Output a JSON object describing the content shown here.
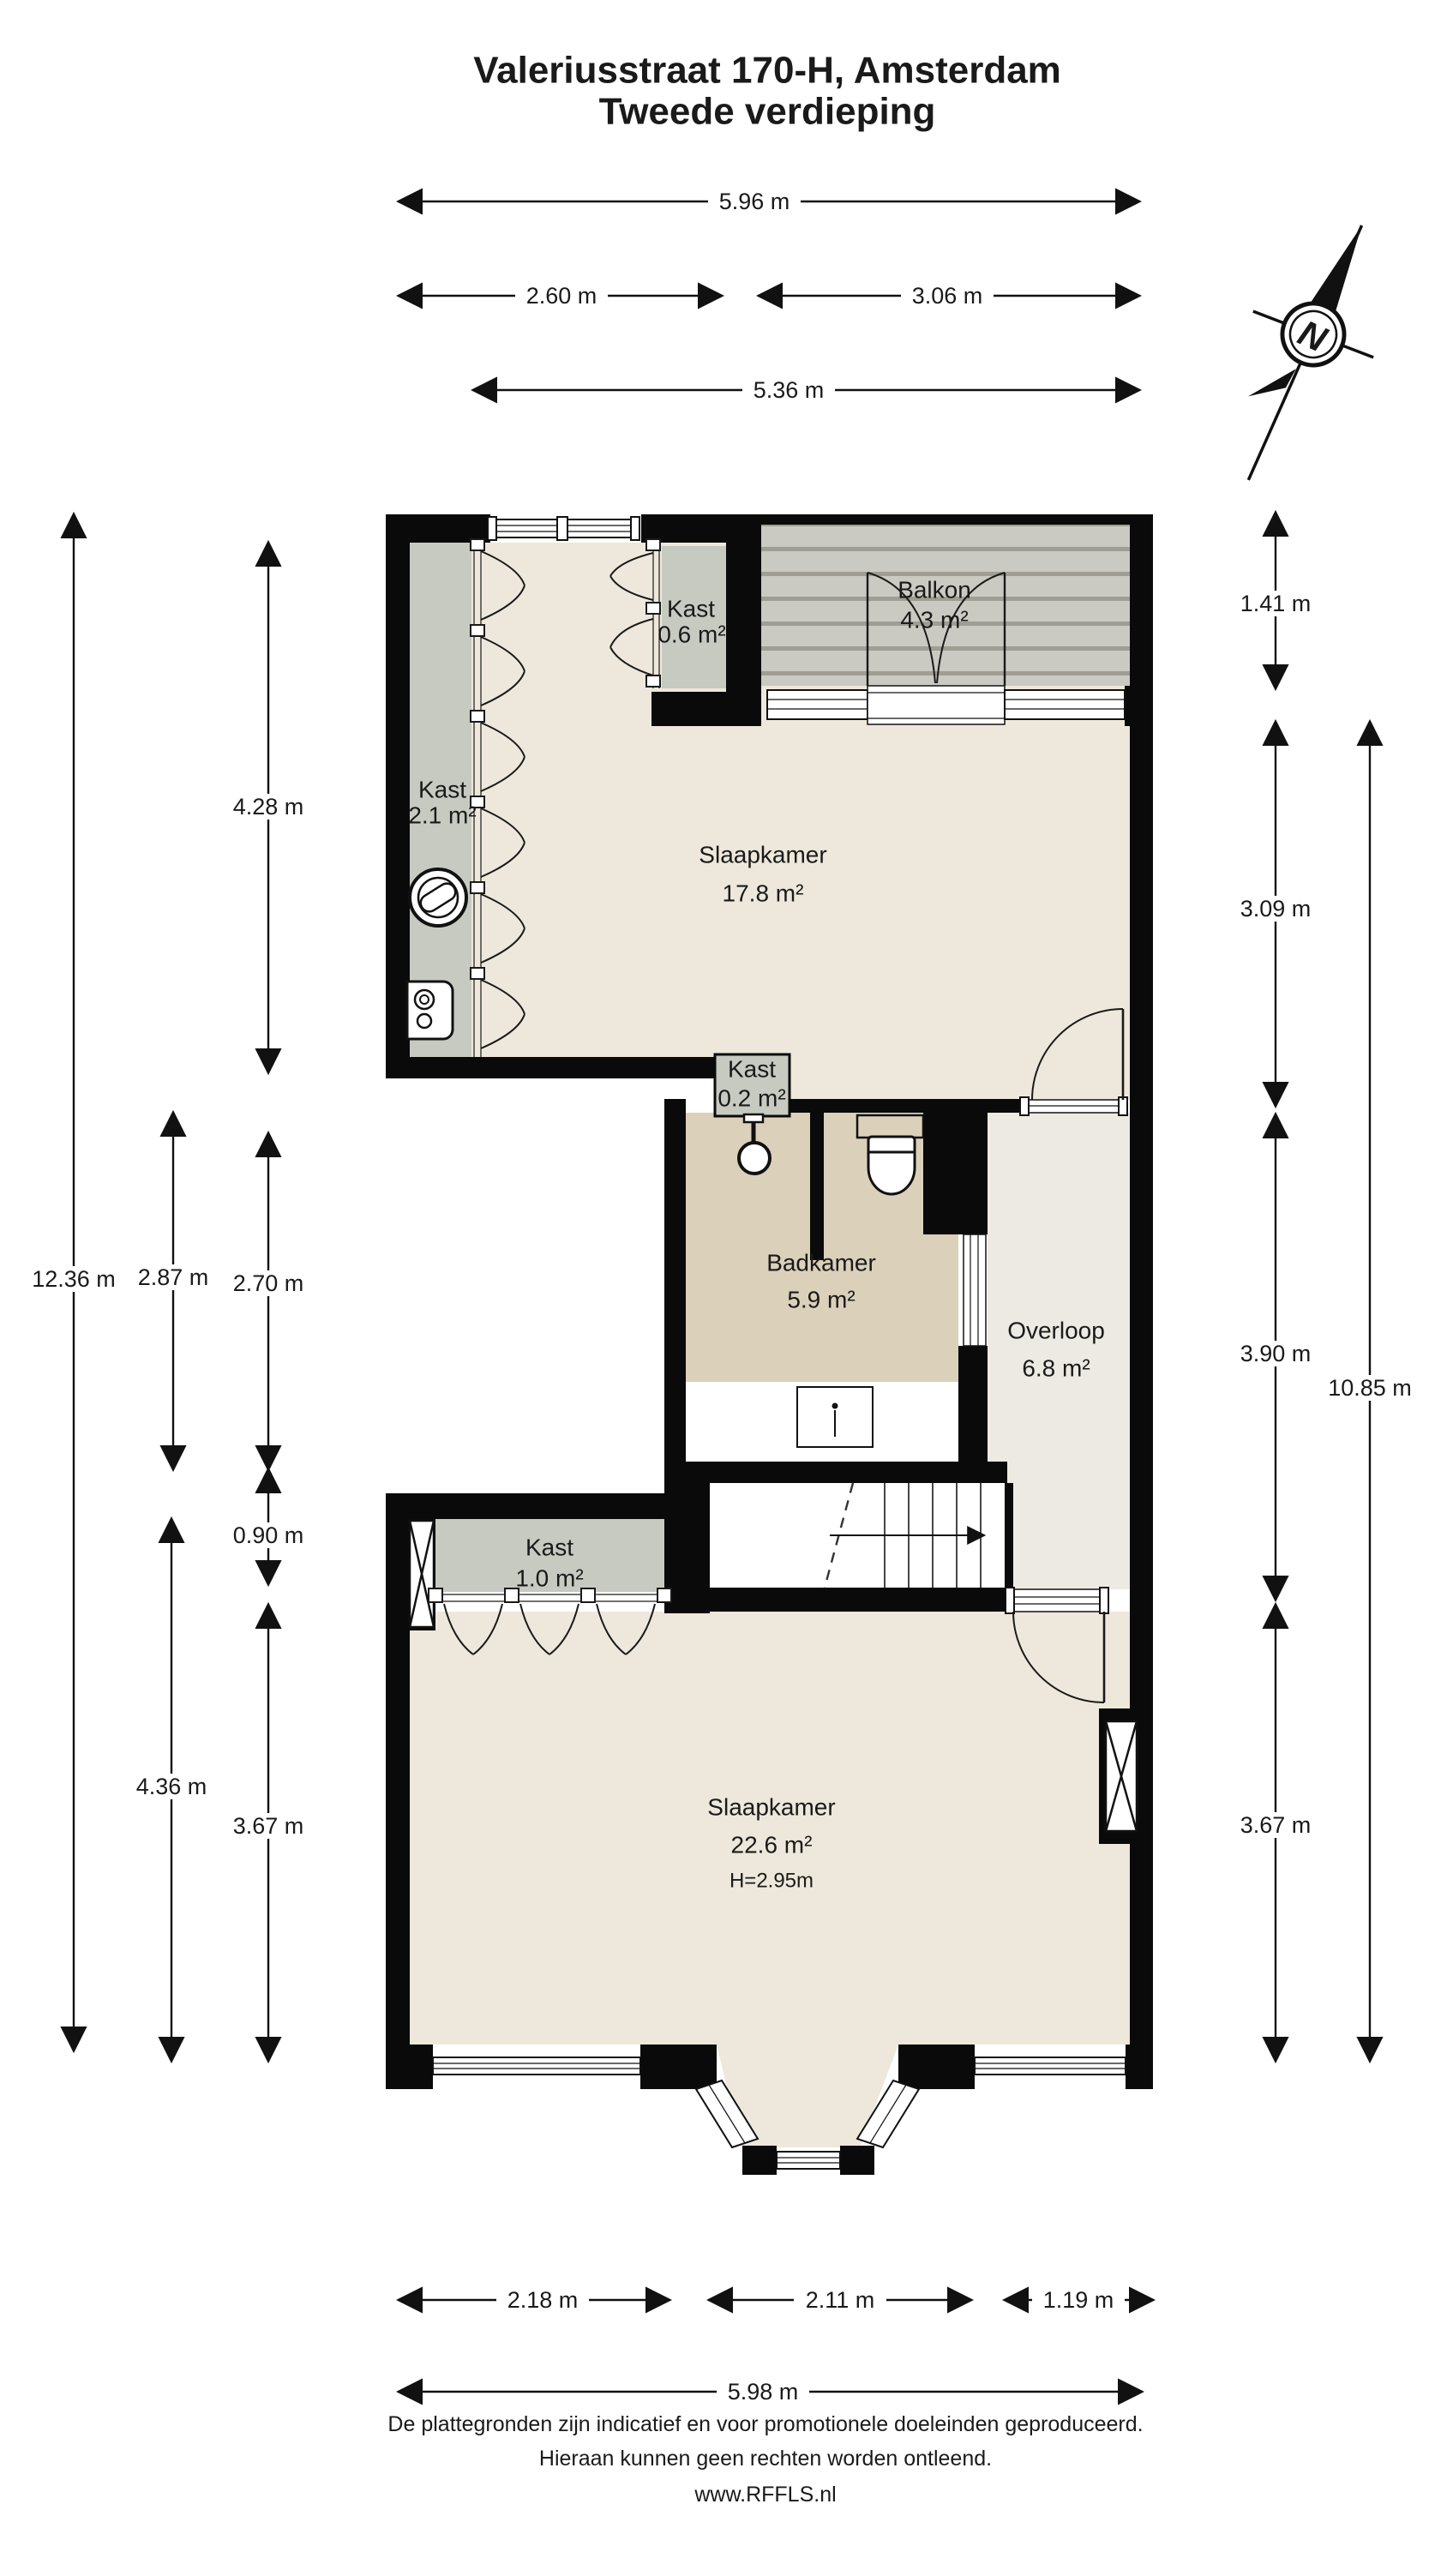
{
  "title": {
    "line1": "Valeriusstraat 170-H, Amsterdam",
    "line2": "Tweede verdieping"
  },
  "compass": {
    "label": "N"
  },
  "rooms": {
    "kast06": {
      "name": "Kast",
      "area": "0.6 m²"
    },
    "balkon": {
      "name": "Balkon",
      "area": "4.3 m²"
    },
    "kast21": {
      "name": "Kast",
      "area": "2.1 m²"
    },
    "slaapkamer1": {
      "name": "Slaapkamer",
      "area": "17.8 m²"
    },
    "kast02": {
      "name": "Kast",
      "area": "0.2 m²"
    },
    "badkamer": {
      "name": "Badkamer",
      "area": "5.9 m²"
    },
    "overloop": {
      "name": "Overloop",
      "area": "6.8 m²"
    },
    "kast10": {
      "name": "Kast",
      "area": "1.0 m²"
    },
    "slaapkamer2": {
      "name": "Slaapkamer",
      "area": "22.6 m²",
      "height": "H=2.95m"
    }
  },
  "dimensions": {
    "top": [
      {
        "label": "5.96 m"
      },
      {
        "label": "2.60 m"
      },
      {
        "label": "3.06 m"
      },
      {
        "label": "5.36 m"
      }
    ],
    "left": [
      {
        "label": "12.36 m"
      },
      {
        "label": "4.28 m"
      },
      {
        "label": "2.87 m"
      },
      {
        "label": "2.70 m"
      },
      {
        "label": "0.90 m"
      },
      {
        "label": "4.36 m"
      },
      {
        "label": "3.67 m"
      }
    ],
    "right": [
      {
        "label": "1.41 m"
      },
      {
        "label": "3.09 m"
      },
      {
        "label": "3.90 m"
      },
      {
        "label": "3.67 m"
      },
      {
        "label": "10.85 m"
      }
    ],
    "bottom": [
      {
        "label": "2.18 m"
      },
      {
        "label": "2.11 m"
      },
      {
        "label": "1.19 m"
      },
      {
        "label": "5.98 m"
      }
    ]
  },
  "footer": {
    "line1": "De plattegronden zijn indicatief en voor promotionele doeleinden geproduceerd.",
    "line2": "Hieraan kunnen geen rechten worden ontleend.",
    "line3": "www.RFFLS.nl"
  },
  "colors": {
    "wall": "#0a0a0a",
    "room": "#EDE8DB",
    "closet": "#C7CAC1",
    "bathroom": "#DBD0BA",
    "hall": "#ECEAE2",
    "balcony_base": "#CBCAC2",
    "balcony_stripe": "#9F9D94",
    "text": "#1a1a1a"
  }
}
